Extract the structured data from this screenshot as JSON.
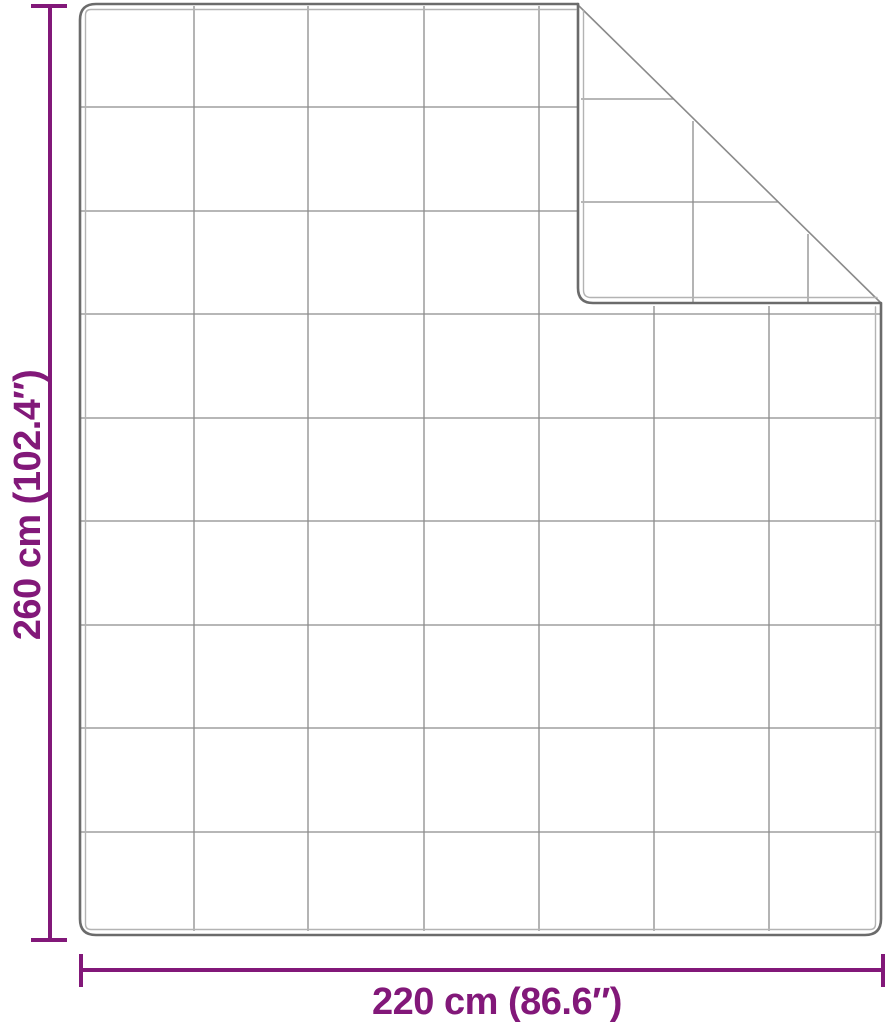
{
  "diagram": {
    "subject": "quilted-blanket-with-folded-corner",
    "height_label": "260 cm (102.4″)",
    "width_label": "220 cm (86.6″)"
  },
  "blanket": {
    "grid_columns": 7,
    "grid_rows": 9,
    "folded_corner": "top-right",
    "flap_grid_columns": 2,
    "flap_grid_rows": 2
  },
  "colors": {
    "accent": "#821879",
    "edge": "#6b6b6b",
    "edge_inner": "#b3b3b3",
    "grid": "#8c8c8c",
    "fold": "#8a8a8a",
    "background": "#ffffff"
  }
}
